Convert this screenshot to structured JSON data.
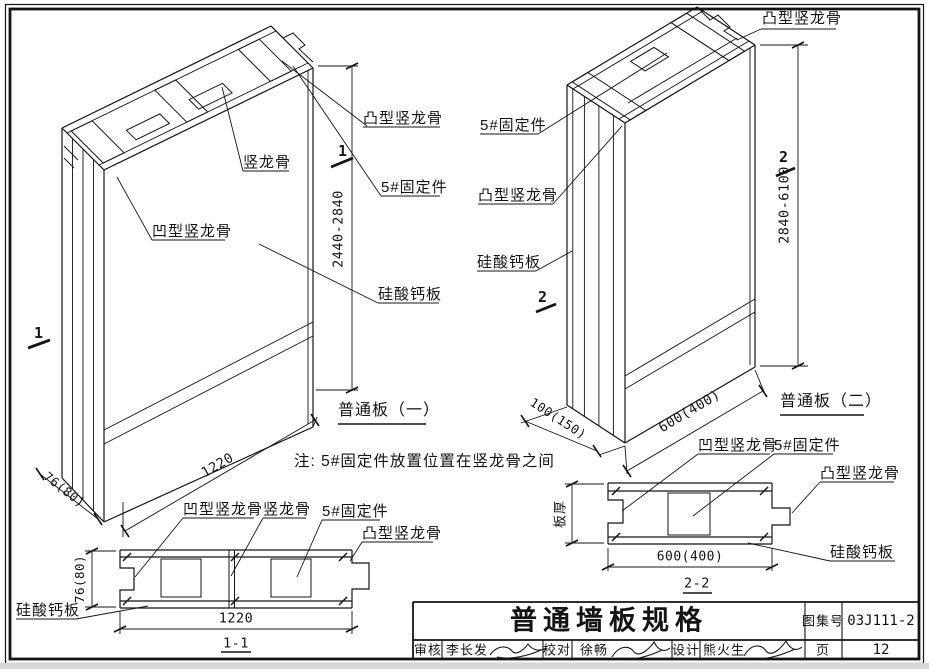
{
  "drawing": {
    "panel1": {
      "caption": "普通板（一）",
      "section_mark": "1",
      "label_convex_stud": "凸型竖龙骨",
      "label_stud": "竖龙骨",
      "label_fixing": "5#固定件",
      "label_concave_stud": "凹型竖龙骨",
      "label_board": "硅酸钙板",
      "dim_height": "2440-2840",
      "dim_width": "1220",
      "dim_thickness": "76(80)"
    },
    "panel2": {
      "caption": "普通板（二）",
      "section_mark": "2",
      "label_convex_stud_top": "凸型竖龙骨",
      "label_fixing": "5#固定件",
      "label_convex_stud": "凸型竖龙骨",
      "label_board": "硅酸钙板",
      "dim_height": "2840-6100",
      "dim_width": "600(400)",
      "dim_thickness": "100(150)"
    },
    "note": "注: 5#固定件放置位置在竖龙骨之间",
    "section11": {
      "caption": "1-1",
      "label_concave_stud": "凹型竖龙骨",
      "label_stud": "竖龙骨",
      "label_fixing": "5#固定件",
      "label_convex_stud": "凸型竖龙骨",
      "label_board": "硅酸钙板",
      "dim_width": "1220",
      "dim_thickness": "76(80)"
    },
    "section22": {
      "caption": "2-2",
      "label_concave_stud": "凹型竖龙骨",
      "label_fixing": "5#固定件",
      "label_convex_stud": "凸型竖龙骨",
      "label_board": "硅酸钙板",
      "label_thickness": "板厚",
      "dim_width": "600(400)"
    },
    "title_block": {
      "title": "普通墙板规格",
      "atlas_label": "图集号",
      "atlas_no": "03J111-2",
      "page_label": "页",
      "page_no": "12",
      "audit_label": "审核",
      "audit_name": "李长发",
      "proof_label": "校对",
      "proof_name": "徐畅",
      "design_label": "设计",
      "design_name": "熊火生"
    },
    "colors": {
      "ink": "#141414",
      "paper": "#ffffff"
    }
  }
}
